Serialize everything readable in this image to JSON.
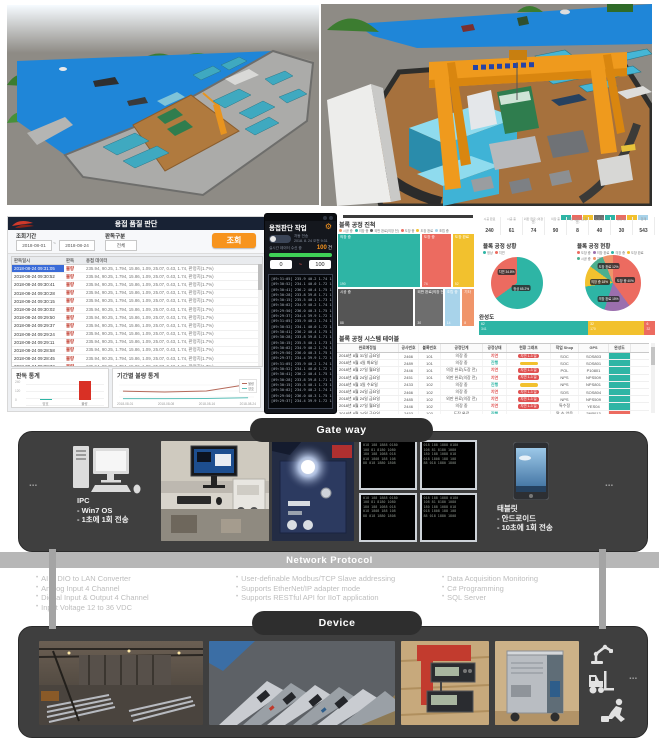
{
  "palette": {
    "teal": "#2eb5a5",
    "red": "#ec6b60",
    "yellow": "#f2c12e",
    "purple": "#9b6fae",
    "orange_button": "#f7941e",
    "progress_green": "#3fd157",
    "dark_panel": "#3f3f3f",
    "band_gray": "#b7b7b7",
    "crane_orange": "#ef9a1d",
    "water_blue": "#1f86d8"
  },
  "dashboard_left": {
    "header_title": "용접 품질 판단",
    "filters": {
      "period_label": "조회기간",
      "period_from": "2018-08-01",
      "period_tilde": "~",
      "period_to": "2018-08-24",
      "type_label": "판독구분",
      "type_value": "전체",
      "search_button": "조회"
    },
    "table": {
      "headers": [
        "판독일시",
        "판독",
        "용접 데이터"
      ],
      "result_value": "불량",
      "detail_value": "235.94, 90.25, 1.794, 15.86, 1.09, 25.07, 0.43, 1.74, 판정치(1.7%)",
      "rows": [
        "2018-08-24 09:31:05",
        "2018-08-24 09:30:52",
        "2018-08-24 09:30:41",
        "2018-08-24 09:30:28",
        "2018-08-24 09:30:15",
        "2018-08-24 09:30:02",
        "2018-08-24 09:29:50",
        "2018-08-24 09:29:37",
        "2018-08-24 09:29:24",
        "2018-08-24 09:29:11",
        "2018-08-24 09:28:58",
        "2018-08-24 09:28:45",
        "2018-08-24 09:28:32",
        "2018-08-24 09:28:19"
      ]
    }
  },
  "mobile_app": {
    "title": "용접판단 작업",
    "auto_label": "자동 전송",
    "time_label": "2018. 8. 24 오전 9:31",
    "recv_label": "실시간 데이터 수신 중",
    "count_value": "100",
    "count_unit": "건",
    "range_from": "0",
    "range_sep": "~",
    "range_to": "100",
    "log_repeat": 3,
    "log_lines": [
      "[09:31:05] 235.9 40.2 1.74 15.8 1.09 수신",
      "[09:30:52] 234.1 40.0 1.72 15.7 1.08 수신",
      "[09:30:41] 236.2 40.4 1.75 15.9 1.10 수신",
      "[09:30:28] 233.8 39.8 1.71 15.6 1.07 수신",
      "[09:30:15] 235.5 40.1 1.73 15.8 1.09 수신",
      "[09:30:02] 234.9 40.2 1.74 15.7 1.08 수신",
      "[09:29:50] 236.0 40.3 1.75 15.9 1.10 수신",
      "[09:29:37] 234.4 39.9 1.72 15.6 1.07 수신"
    ]
  },
  "dashboard_right": {
    "mini_tiles": [
      "#2eb5a5",
      "#ec6b60",
      "#f2c12e",
      "#6e6e6e",
      "#2eb5a5",
      "#ec6b60",
      "#f2c12e",
      "#a8d3ea"
    ]
  },
  "chart_data": [
    {
      "id": "reading-stats",
      "type": "bar",
      "title": "판독 통계",
      "categories": [
        "양호",
        "불량"
      ],
      "values": [
        12,
        231
      ],
      "colors": [
        "#2eb5a5",
        "#d93025"
      ],
      "ylim": [
        0,
        240
      ],
      "yticks": [
        "240",
        "120",
        "0"
      ]
    },
    {
      "id": "defect-trend",
      "type": "line",
      "title": "기간별 불량 통계",
      "x": [
        "2018-08-01",
        "2018-08-08",
        "2018-08-16",
        "2018-08-24"
      ],
      "series": [
        {
          "name": "불량",
          "color": "#b5695a",
          "values": [
            46,
            41,
            47,
            86
          ]
        },
        {
          "name": "양호",
          "color": "#5bbfb8",
          "values": [
            2,
            2,
            3,
            7
          ]
        }
      ],
      "ylim": [
        0,
        100
      ],
      "grid": true,
      "legend_position": "right-top"
    },
    {
      "id": "block-progress",
      "type": "treemap",
      "title": "블록 공정 진척",
      "legend": [
        {
          "label": "시공 중",
          "color": "#f0956a"
        },
        {
          "label": "의장 중",
          "color": "#2eb5a5"
        },
        {
          "label": "외판 완료(의장 전)",
          "color": "#5a5a5a"
        },
        {
          "label": "도장 중",
          "color": "#ec6b60"
        },
        {
          "label": "도장 완료",
          "color": "#f2c12e"
        },
        {
          "label": "조립 중",
          "color": "#a8d3ea"
        }
      ],
      "rows": [
        [
          {
            "label": "의장 중",
            "value": "190",
            "color": "#2eb5a5",
            "flex": 62
          },
          {
            "label": "도장 중",
            "value": "74",
            "color": "#ec6b60",
            "flex": 22
          },
          {
            "label": "도장 완료",
            "value": "52",
            "color": "#f2c12e",
            "flex": 16
          }
        ],
        [
          {
            "label": "시공 중",
            "value": "88",
            "color": "#555555",
            "flex": 58
          },
          {
            "label": "외판 완료(의장 전)",
            "value": "30",
            "color": "#6e6e6e",
            "flex": 21
          },
          {
            "label": "조립 중",
            "value": "14",
            "color": "#a8d3ea",
            "flex": 12
          },
          {
            "label": "기타",
            "value": "8",
            "color": "#f0956a",
            "flex": 9
          }
        ]
      ]
    },
    {
      "id": "block-status",
      "type": "pie",
      "title": "블록 공정 상황",
      "legend": [
        {
          "label": "정상",
          "color": "#2eb5a5"
        },
        {
          "label": "지연",
          "color": "#ec6b60"
        }
      ],
      "slices": [
        {
          "label": "정상",
          "pct": 65,
          "color": "#2eb5a5"
        },
        {
          "label": "지연",
          "pct": 35,
          "color": "#ec6b60"
        }
      ],
      "chips": [
        {
          "text": "정상 65.2%",
          "x": 58,
          "y": 60
        },
        {
          "text": "지연 34.8%",
          "x": 30,
          "y": 28
        }
      ]
    },
    {
      "id": "block-current",
      "type": "pie",
      "title": "블록 공정 현황",
      "legend": [
        {
          "label": "도장 중",
          "color": "#ec6b60"
        },
        {
          "label": "의장 완료",
          "color": "#9b6fae"
        },
        {
          "label": "의장 중",
          "color": "#2eb5a5"
        },
        {
          "label": "도장 완료",
          "color": "#f2c12e"
        },
        {
          "label": "시공 중",
          "color": "#4caf8e"
        },
        {
          "label": "기타",
          "color": "#f0956a"
        }
      ],
      "slices": [
        {
          "label": "도장 중",
          "pct": 40,
          "color": "#ec6b60"
        },
        {
          "label": "의장 완료",
          "pct": 15,
          "color": "#9b6fae"
        },
        {
          "label": "의장 중",
          "pct": 18,
          "color": "#2eb5a5"
        },
        {
          "label": "도장 완료",
          "pct": 12,
          "color": "#f2c12e"
        },
        {
          "label": "시공 중",
          "pct": 9,
          "color": "#4caf8e"
        },
        {
          "label": "기타",
          "pct": 6,
          "color": "#f0956a"
        }
      ],
      "chips": [
        {
          "text": "도장 중 40%",
          "x": 72,
          "y": 45
        },
        {
          "text": "의장 완료 15%",
          "x": 42,
          "y": 78
        },
        {
          "text": "의장 중 18%",
          "x": 26,
          "y": 48
        },
        {
          "text": "도장 완료 12%",
          "x": 42,
          "y": 20
        }
      ]
    },
    {
      "id": "completion",
      "type": "bar",
      "variant": "stacked-horizontal",
      "title": "완성도",
      "segments": [
        {
          "label": "완료",
          "pct": 62,
          "count": "341",
          "color": "#2eb5a5"
        },
        {
          "label": "진행",
          "pct": 32,
          "count": "170",
          "color": "#f2c12e"
        },
        {
          "label": "지연",
          "pct": 6,
          "count": "32",
          "color": "#ec6b60"
        }
      ]
    },
    {
      "id": "block-summary",
      "type": "table",
      "title": "",
      "headers": [
        "시공 완료",
        "시공 중",
        "외판 완료 (의장 전)",
        "의장 중",
        "의장 완료 (도장 전)",
        "도장 전",
        "도장 중",
        "합계"
      ],
      "values": [
        "240",
        "61",
        "74",
        "90",
        "8",
        "40",
        "30",
        "543"
      ]
    },
    {
      "id": "block-table",
      "type": "table",
      "title": "블록 공정 시스템 테이블",
      "headers": [
        "완료예정일",
        "공사번호",
        "블록번호",
        "공정단계",
        "공정상태",
        "현황 그래프",
        "작업 Shop",
        "GPS",
        "완성도"
      ],
      "delay_badge": "지연 1-3 일",
      "rows": [
        {
          "date": "2018년 8월 31일 금요일",
          "proj": "2466",
          "block": "101",
          "stage": "의장 중",
          "state": "지연",
          "state_color": "#e05252",
          "badge": "red",
          "shop": "SOC",
          "gps": "SOS803",
          "done": "#2eb5a5"
        },
        {
          "date": "2018년 9월 4일 화요일",
          "proj": "2489",
          "block": "101",
          "stage": "의장 중",
          "state": "진행",
          "state_color": "#2eb5a5",
          "badge": "yellow",
          "shop": "SOC",
          "gps": "SOS801",
          "done": "#2eb5a5"
        },
        {
          "date": "2018년 8월 27일 월요일",
          "proj": "2446",
          "block": "101",
          "stage": "의장 완료(도장 전)",
          "state": "지연",
          "state_color": "#e05252",
          "badge": "red",
          "shop": "POL",
          "gps": "P10801",
          "done": "#2eb5a5"
        },
        {
          "date": "2018년 8월 24일 금요일",
          "proj": "2451",
          "block": "101",
          "stage": "외판 완료(의장 전)",
          "state": "지연",
          "state_color": "#e05252",
          "badge": "red",
          "shop": "NPS",
          "gps": "NPS509",
          "done": "#2eb5a5"
        },
        {
          "date": "2018년 9월 3일 수요일",
          "proj": "2433",
          "block": "102",
          "stage": "의장 중",
          "state": "진행",
          "state_color": "#2eb5a5",
          "badge": "yellow",
          "shop": "NPS",
          "gps": "NPS801",
          "done": "#2eb5a5"
        },
        {
          "date": "2018년 8월 24일 금요일",
          "proj": "2466",
          "block": "102",
          "stage": "의장 중",
          "state": "지연",
          "state_color": "#e05252",
          "badge": "red",
          "shop": "SOS",
          "gps": "SOS804",
          "done": "#2eb5a5"
        },
        {
          "date": "2018년 8월 24일 금요일",
          "proj": "2485",
          "block": "102",
          "stage": "외판 완료(의장 전)",
          "state": "지연",
          "state_color": "#e05252",
          "badge": "red",
          "shop": "NPS",
          "gps": "NPS509",
          "done": "#2eb5a5"
        },
        {
          "date": "2018년 8월 27일 월요일",
          "proj": "2446",
          "block": "102",
          "stage": "의장 중",
          "state": "지연",
          "state_color": "#e05252",
          "badge": "red",
          "shop": "특수정",
          "gps": "YES04",
          "done": "#2eb5a5"
        },
        {
          "date": "2018년 8월 24일 금요일",
          "proj": "2453",
          "block": "103",
          "stage": "도장 완료",
          "state": "진행",
          "state_color": "#2eb5a5",
          "badge": null,
          "shop": "알 수 없음",
          "gps": "2NP013",
          "done": "#ec6b60"
        },
        {
          "date": "2018년 8월 17일 금요일",
          "proj": "2434",
          "block": "104",
          "stage": "도장 중",
          "state": "지연",
          "state_color": "#e05252",
          "badge": "red",
          "shop": "NPS",
          "gps": "NPS803",
          "done": "#2eb5a5"
        }
      ]
    }
  ],
  "gateway": {
    "label": "Gate way",
    "left_ellipsis": "...",
    "right_ellipsis": "...",
    "ipc": {
      "title": "IPC",
      "lines": [
        "- Win7 OS",
        "- 1초에 1회 전송"
      ]
    },
    "tablet": {
      "title": "태블릿",
      "lines": [
        "- 안드로이드",
        "- 10초에 1회 전송"
      ]
    },
    "screen_lines": [
      "018 188 1888 0180",
      "108 81 8180 1080",
      "180 188 1088 018",
      "018 1808 188 108",
      "88 018 1880 1808"
    ]
  },
  "network": {
    "label": "Network Protocol",
    "columns": [
      [
        "AI & DIO to LAN Converter",
        "Analog Input 4 Channel",
        "Digital Input & Output 4 Channel",
        "Input Voltage 12 to 36 VDC"
      ],
      [
        "User-definable Modbus/TCP Slave addressing",
        "Supports EtherNet/IP adapter mode",
        "Supports RESTful API for IIoT application"
      ],
      [
        "Data Acquisition Monitoring",
        "C# Programming",
        "SQL Server"
      ]
    ]
  },
  "device": {
    "label": "Device",
    "ellipsis": "...",
    "icons": [
      "robot-arm-icon",
      "forklift-icon",
      "worker-icon"
    ]
  }
}
